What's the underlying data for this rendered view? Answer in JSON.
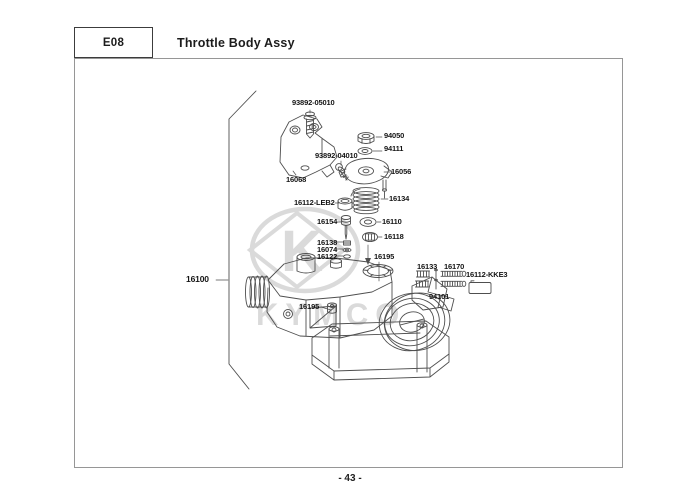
{
  "header": {
    "code": "E08",
    "title": "Throttle Body Assy"
  },
  "footer": {
    "page_number": "- 43 -"
  },
  "watermark": {
    "brand": "KYMCO",
    "logo_letter": "K"
  },
  "colors": {
    "line": "#4f4f4f",
    "label": "#141414",
    "watermark": "#dadada",
    "border": "#969696"
  },
  "diagram": {
    "assembly_number": "16100",
    "parts": [
      {
        "id": "93892-05010",
        "number": "93892-05010",
        "x": 292,
        "y": 99
      },
      {
        "id": "94050",
        "number": "94050",
        "x": 384,
        "y": 132
      },
      {
        "id": "94111",
        "number": "94111",
        "x": 384,
        "y": 145
      },
      {
        "id": "93892-04010",
        "number": "93892-04010",
        "x": 315,
        "y": 152
      },
      {
        "id": "16068",
        "number": "16068",
        "x": 286,
        "y": 176
      },
      {
        "id": "16056",
        "number": "16056",
        "x": 391,
        "y": 168
      },
      {
        "id": "16112-LEB2",
        "number": "16112-LEB2",
        "x": 294,
        "y": 199
      },
      {
        "id": "16134",
        "number": "16134",
        "x": 389,
        "y": 195
      },
      {
        "id": "16154",
        "number": "16154",
        "x": 317,
        "y": 218
      },
      {
        "id": "16110",
        "number": "16110",
        "x": 382,
        "y": 218
      },
      {
        "id": "16118",
        "number": "16118",
        "x": 384,
        "y": 233
      },
      {
        "id": "16138",
        "number": "16138",
        "x": 317,
        "y": 239
      },
      {
        "id": "16074",
        "number": "16074",
        "x": 317,
        "y": 246
      },
      {
        "id": "16122",
        "number": "16122",
        "x": 317,
        "y": 253
      },
      {
        "id": "16195-top",
        "number": "16195",
        "x": 374,
        "y": 253
      },
      {
        "id": "16133",
        "number": "16133",
        "x": 417,
        "y": 263
      },
      {
        "id": "16170",
        "number": "16170",
        "x": 444,
        "y": 263
      },
      {
        "id": "16112-KKE3",
        "number": "16112-KKE3",
        "x": 466,
        "y": 271
      },
      {
        "id": "94101",
        "number": "94101",
        "x": 429,
        "y": 293
      },
      {
        "id": "16100",
        "number": "16100",
        "x": 186,
        "y": 275,
        "big": true
      },
      {
        "id": "16195-side",
        "number": "16195",
        "x": 299,
        "y": 303
      }
    ]
  }
}
